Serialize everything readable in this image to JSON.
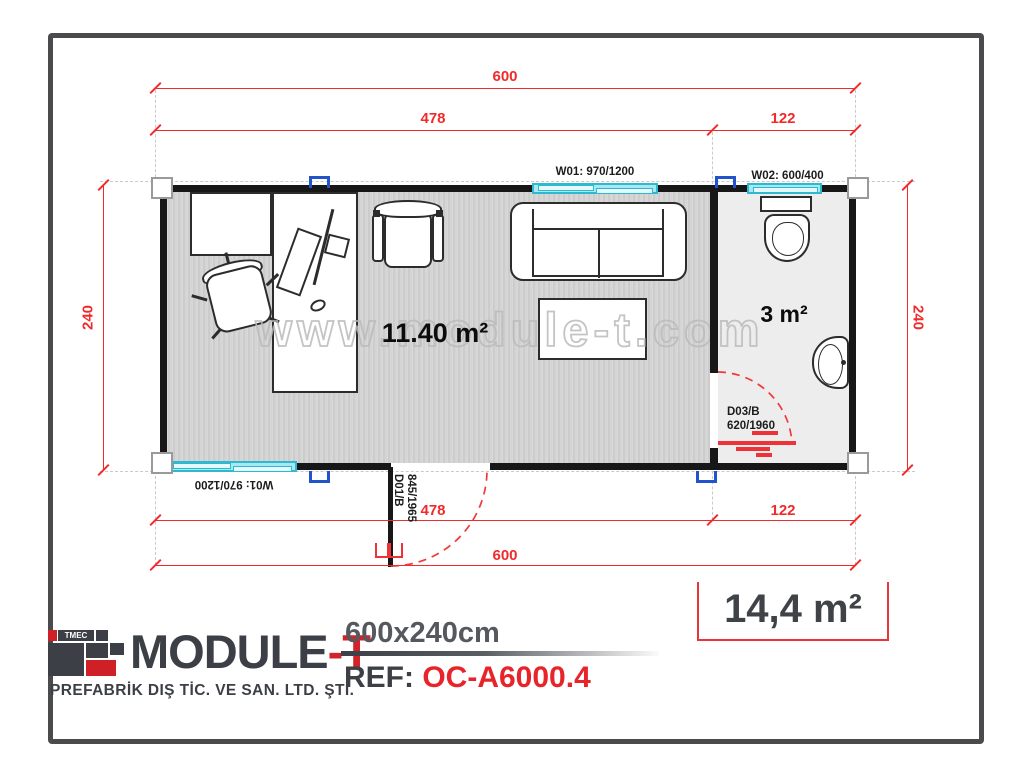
{
  "plan": {
    "watermark": "www.module-t.com",
    "dimensions": {
      "total_width": "600",
      "office_width": "478",
      "bath_width": "122",
      "depth": "240"
    },
    "windows": {
      "w01": "W01: 970/1200",
      "w02": "W02: 600/400"
    },
    "doors": {
      "d01": {
        "code": "D01/B",
        "size": "845/1965"
      },
      "d03": {
        "code": "D03/B",
        "size": "620/1960"
      }
    },
    "rooms": {
      "office_area": "11.40 m²",
      "bathroom_area": "3 m²"
    }
  },
  "footer": {
    "logo_mark": "TMEC",
    "brand_main": "MODULE",
    "brand_suffix": "-T",
    "subtitle": "PREFABRİK DIŞ TİC. VE SAN. LTD. ŞTİ.",
    "model_size": "600x240cm",
    "ref_label": "REF:",
    "ref_code": "OC-A6000.4",
    "total_area": "14,4 m²"
  },
  "colors": {
    "dimension_red": "#f02b2b",
    "accent_red": "#e8343a",
    "window_cyan": "#a7e9f2",
    "connector_blue": "#2353cb",
    "wall_black": "#171717",
    "brand_dark": "#3c4046",
    "frame_gray": "#4b4b4d"
  }
}
